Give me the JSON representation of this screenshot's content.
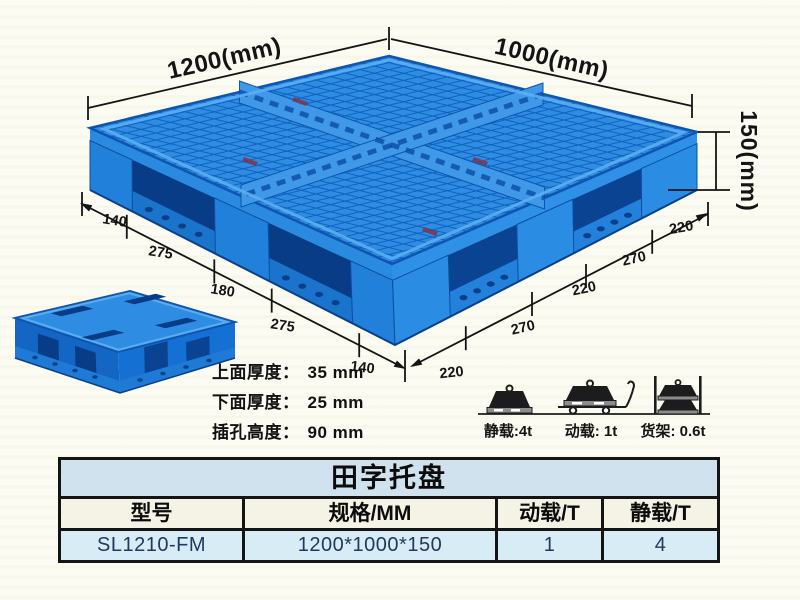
{
  "dimensions": {
    "width_label": "1200(mm)",
    "depth_label": "1000(mm)",
    "height_label": "150(mm)",
    "left_chain": [
      "140",
      "275",
      "180",
      "275",
      "140"
    ],
    "right_chain": [
      "220",
      "270",
      "220",
      "270",
      "220"
    ]
  },
  "specs": [
    {
      "label": "上面厚度：",
      "value": "35 mm"
    },
    {
      "label": "下面厚度：",
      "value": "25 mm"
    },
    {
      "label": "插孔高度：",
      "value": "90 mm"
    }
  ],
  "loads": [
    {
      "icon": "static-load-icon",
      "label": "静载:4t"
    },
    {
      "icon": "dynamic-load-icon",
      "label": "动载: 1t"
    },
    {
      "icon": "rack-load-icon",
      "label": "货架: 0.6t"
    }
  ],
  "table": {
    "title": "田字托盘",
    "headers": [
      "型号",
      "规格/MM",
      "动载/T",
      "静载/T"
    ],
    "row": [
      "SL1210-FM",
      "1200*1000*150",
      "1",
      "4"
    ]
  },
  "colors": {
    "pallet_blue": "#2e8ce2",
    "pallet_dark": "#0a4391",
    "table_title_bg": "#cfe2ee",
    "table_header_bg": "#f5f2e6",
    "table_data_bg": "#d8ecf6",
    "background": "#fbfbf2"
  }
}
